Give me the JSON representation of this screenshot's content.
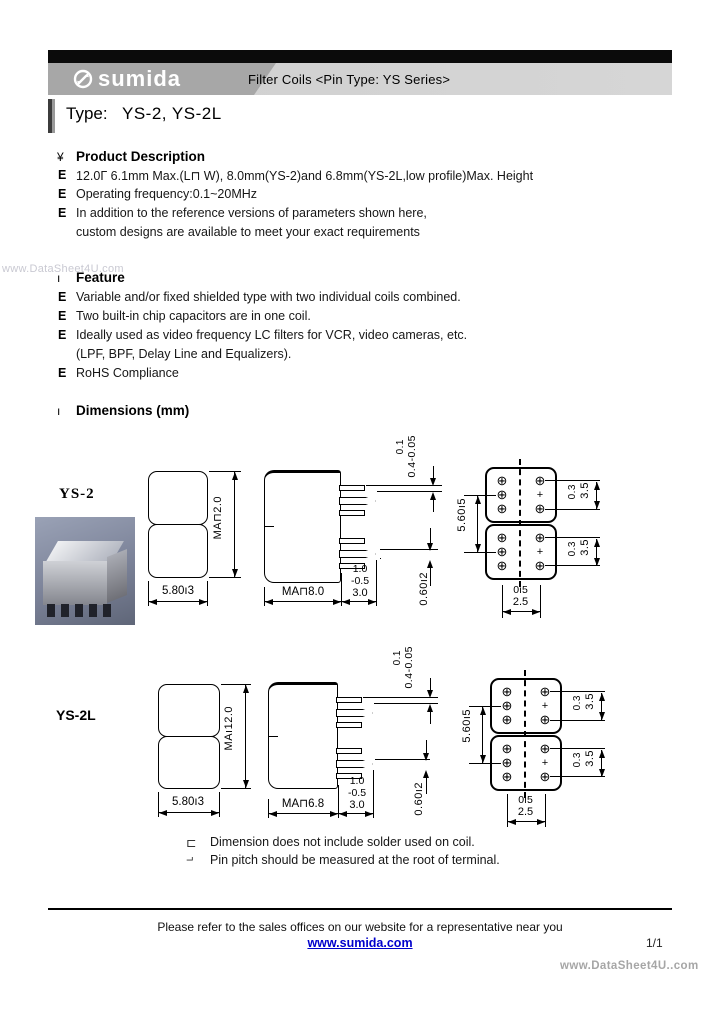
{
  "header": {
    "brand": "sumida",
    "product_line": "Filter Coils <Pin Type: YS Series>",
    "type_label": "Type:",
    "type_value": "YS-2, YS-2L"
  },
  "watermarks": {
    "left": "www.DataSheet4U.com",
    "bottom_right": "www.DataSheet4U..com"
  },
  "product_description": {
    "bullet": "¥",
    "title": "Product Description",
    "lines": [
      {
        "bullet": "E",
        "text": "12.0Γ 6.1mm Max.(L⊓ W), 8.0mm(YS-2)and 6.8mm(YS-2L,low profile)Max. Height"
      },
      {
        "bullet": "E",
        "text": "Operating frequency:0.1~20MHz"
      },
      {
        "bullet": "E",
        "text": "In addition to the reference versions of parameters shown here,"
      },
      {
        "bullet": "",
        "text": "custom designs are available to meet your exact requirements"
      }
    ]
  },
  "feature": {
    "bullet": "ı",
    "title": "Feature",
    "lines": [
      {
        "bullet": "E",
        "text": "Variable and/or fixed shielded type with two individual coils combined."
      },
      {
        "bullet": "E",
        "text": "Two built-in chip capacitors are in one coil."
      },
      {
        "bullet": "E",
        "text": "Ideally used as video frequency LC filters for VCR, video cameras, etc."
      },
      {
        "bullet": "",
        "text": "(LPF, BPF, Delay Line and Equalizers)."
      },
      {
        "bullet": "E",
        "text": "RoHS Compliance"
      }
    ]
  },
  "dimensions": {
    "bullet": "ı",
    "title": "Dimensions (mm)",
    "ys2": {
      "label": "YS-2",
      "front": {
        "width": "5.80ı3",
        "height": "MA⊓2.0"
      },
      "side": {
        "width": "MA⊓8.0",
        "pin_tol_1": "0.1",
        "pin_tol_2": "0.4-0.05",
        "len_1": "1.0",
        "len_2": "-0.5",
        "len_3": "3.0",
        "thickness": "0.60ı2"
      },
      "bottom": {
        "height": "5.60ı5",
        "span_top_1": "0.3",
        "span_top_2": "3.5",
        "span_bot_1": "0.3",
        "span_bot_2": "3.5",
        "pitch_1": "0ı5",
        "pitch_2": "2.5"
      }
    },
    "ys2l": {
      "label": "YS-2L",
      "front": {
        "width": "5.80ı3",
        "height": "MAı12.0"
      },
      "side": {
        "width": "MA⊓6.8",
        "pin_tol_1": "0.1",
        "pin_tol_2": "0.4-0.05",
        "len_1": "1.0",
        "len_2": "-0.5",
        "len_3": "3.0",
        "thickness": "0.60ı2"
      },
      "bottom": {
        "height": "5.60ı5",
        "span_top_1": "0.3",
        "span_top_2": "3.5",
        "span_bot_1": "0.3",
        "span_bot_2": "3.5",
        "pitch_1": "0ı5",
        "pitch_2": "2.5"
      }
    }
  },
  "notes": [
    {
      "bullet": "⊏",
      "text": "Dimension does not include solder used on coil."
    },
    {
      "bullet": "⌐",
      "text": "Pin pitch should be measured at the root of terminal."
    }
  ],
  "footer": {
    "message": "Please refer to the sales offices on our website for a representative near you",
    "link": "www.sumida.com",
    "page": "1/1"
  },
  "glyphs": {
    "pin_marker": "⊕",
    "pin_cross": "+"
  }
}
